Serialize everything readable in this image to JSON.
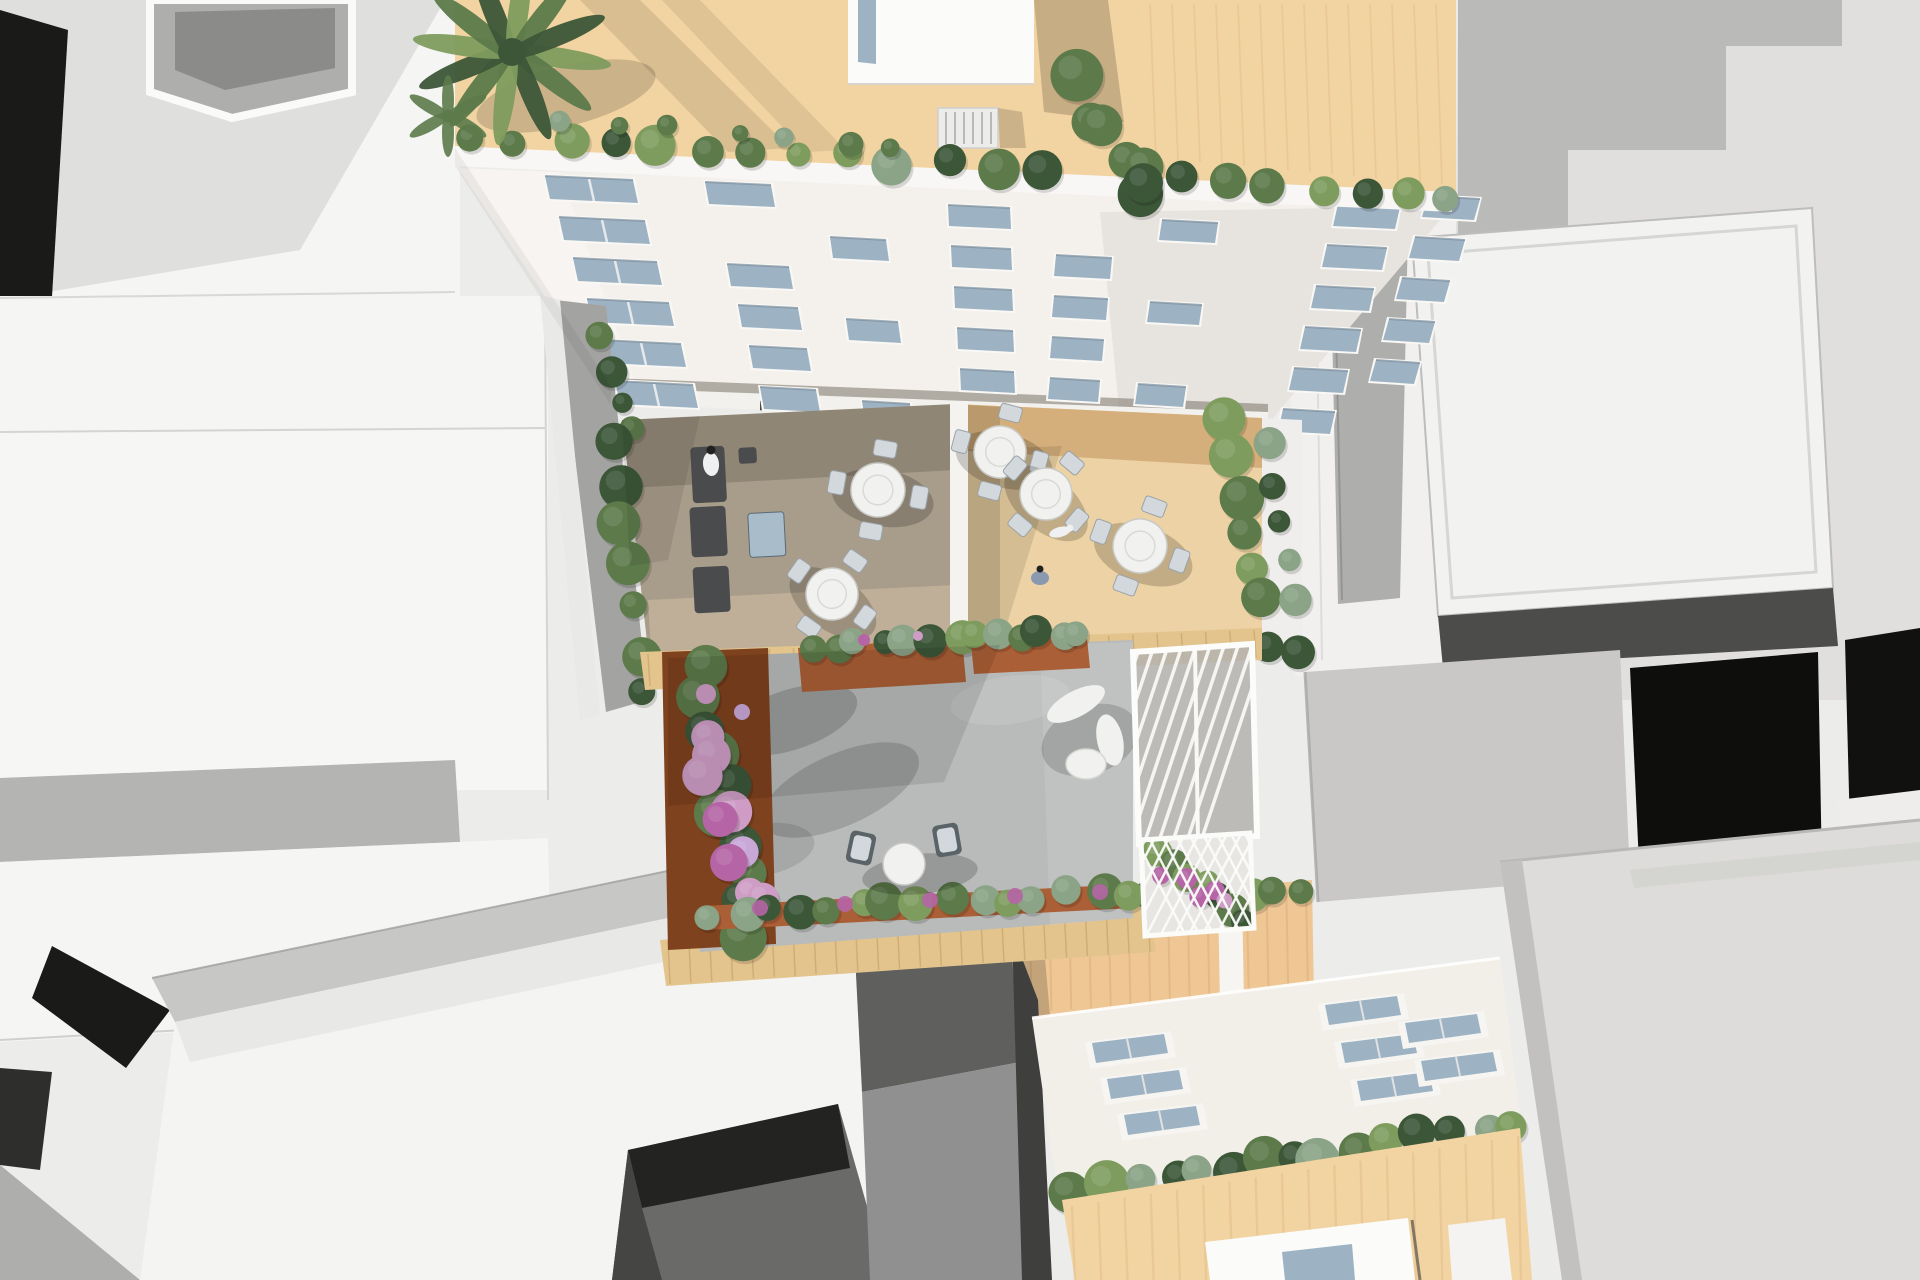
{
  "meta": {
    "title": "Aerial top-down 3D architectural rendering of a city block with rooftop terraces, courtyard garden and surrounding massing models"
  },
  "palette": {
    "bg": "#ececeb",
    "white_roof": "#f5f5f4",
    "white_bright": "#fbfbfa",
    "gray_soft": "#c7c7c5",
    "gray_mid": "#aeaeac",
    "gray_dark": "#8b8b8a",
    "near_black": "#1a1a19",
    "black_void": "#0e0e0d",
    "stucco": "#dddcda",
    "facade_white": "#f4f1ec",
    "window_glass": "#9db2c3",
    "tan_roof": "#f2d4a2",
    "tan_wall": "#eec795",
    "tile_band": "#e3c48d",
    "wood_terrace": "#a89c8a",
    "wood_terrace_light": "#c9b89e",
    "beige_terrace": "#ecd2a4",
    "beige_shadow": "#d2ab77",
    "concrete": "#b8bbba",
    "corten": "#ab5f36",
    "corten_dark": "#7e421f",
    "green_dark": "#3c5638",
    "green_mid": "#5c7a4a",
    "green_light": "#7e9c5e",
    "green_sage": "#8ba386",
    "flower_pink": "#cf9cc6",
    "flower_magenta": "#b565a5",
    "flower_lilac": "#c9a8d8",
    "furniture_white": "#f1f1ef",
    "chair_light": "#d3d8dc",
    "sofa_dark": "#494b4d",
    "ottoman_blue": "#a9bcca",
    "figure_white": "#eef0f2",
    "figure_dark": "#23211f"
  },
  "scene": {
    "top_building": {
      "label": "upper residential building",
      "features": [
        "tan roof terrace",
        "palm tree",
        "rooftop penthouse with skylight slot",
        "stair bulkhead",
        "parapet shrub row",
        "white street facade with staggered windows",
        "rooftop tree"
      ]
    },
    "terraces": {
      "left": {
        "floor": "wood deck in shadow",
        "furniture": [
          "lounge sofa set",
          "blue ottoman table",
          "two round dining tables with four chairs",
          "standing person",
          "seated person"
        ]
      },
      "right": {
        "floor": "sunlit beige deck",
        "furniture": [
          "three round dining tables with four chairs",
          "dog",
          "crouching person"
        ],
        "edge": "hedge along right parapet"
      }
    },
    "courtyard": {
      "floor": "concrete paving with tree shadow",
      "features": [
        "corten planter boxes",
        "lilac flower bed",
        "round table with two lounge chairs",
        "curved white bench with oval table",
        "white glass pergola",
        "flower trellis",
        "south planter row",
        "tile borders"
      ]
    },
    "lower_building": {
      "features": [
        "tan courtyard wall with hedge",
        "white roof slab with skylights",
        "hedge row",
        "tan facade",
        "white penthouse with blue window",
        "gray side roof"
      ]
    },
    "context": {
      "features": [
        "white massing rooftops",
        "lightwell voids",
        "black shadow gaps",
        "stepped shadow on tall block",
        "framed flat roof",
        "stucco block bottom right",
        "courtyard hole in bottom-left building"
      ]
    }
  },
  "counts": {
    "terrace_dining_tables": 5,
    "courtyard_seating_groups": 2,
    "skylights_left_group": 3,
    "skylights_right_group": 5,
    "facade_window_rows": 6
  }
}
